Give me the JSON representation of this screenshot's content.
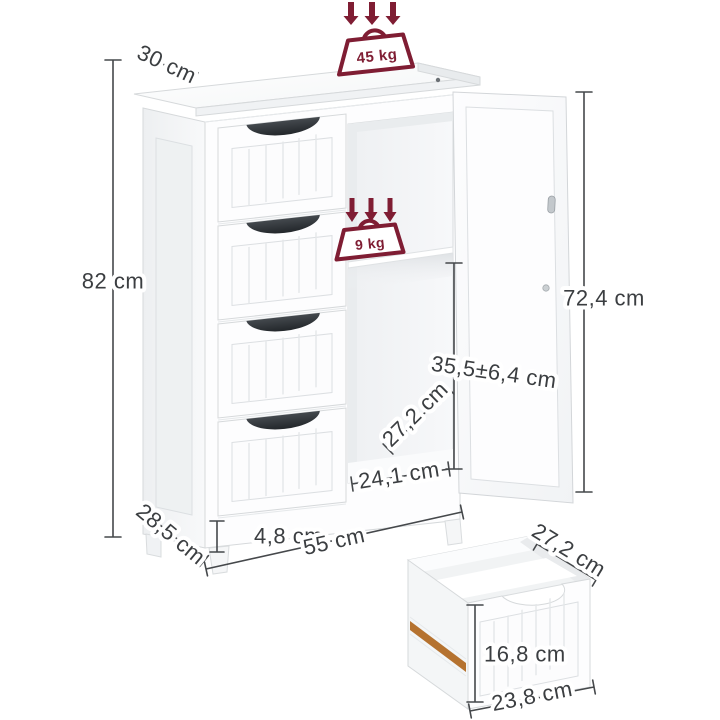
{
  "diagram": {
    "type": "product-dimension-diagram",
    "subject": "white floor cabinet with 4 drawers, open door, middle shelf and detached drawer",
    "colors": {
      "accent_maroon": "#7f1d33",
      "annotation_gray": "#3b3e41",
      "wood_rail": "#b5722f",
      "furniture_white": "#fdfdfe"
    }
  },
  "loads": {
    "top_load": "45 kg",
    "shelf_load": "9 kg"
  },
  "dimensions": {
    "top_depth": "30 cm",
    "overall_height": "82 cm",
    "door_height": "72,4 cm",
    "shelf_clearance": "35,5±6,4 cm",
    "interior_depth": "27,2 cm",
    "opening_width": "24,1 cm",
    "leg_height": "4,8 cm",
    "overall_width": "55 cm",
    "bottom_depth": "28,5 cm"
  },
  "drawer_dimensions": {
    "depth": "27,2 cm",
    "height": "16,8 cm",
    "width": "23,8 cm"
  }
}
